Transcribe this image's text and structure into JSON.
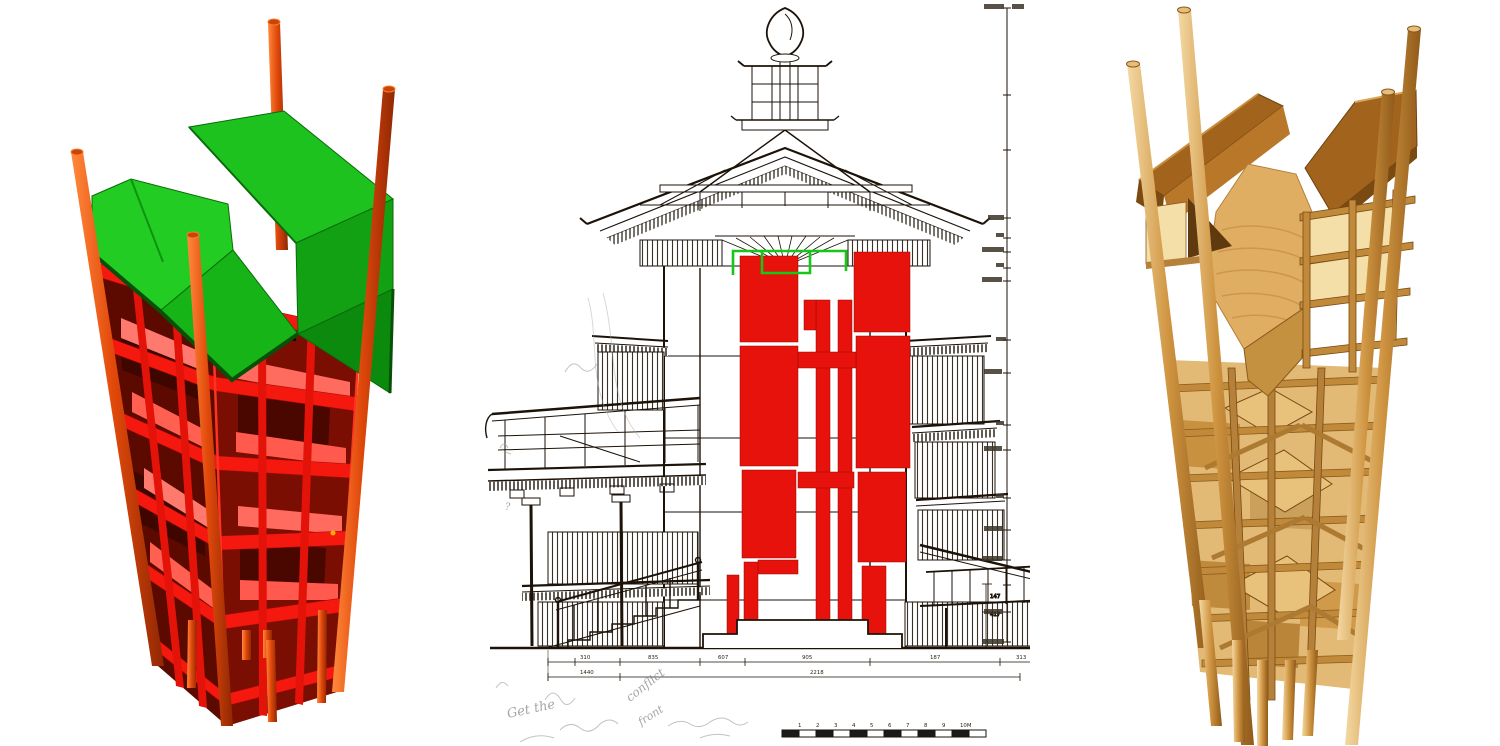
{
  "figure": {
    "panels": [
      {
        "id": "left-model",
        "role": "structural-frame-model-red-green"
      },
      {
        "id": "center-section",
        "role": "pagoda-cross-section-drawing"
      },
      {
        "id": "right-model",
        "role": "timber-frame-wood-model"
      }
    ]
  },
  "colors": {
    "left_model": {
      "post": "#d23c05",
      "frame": "#f5180f",
      "floor_slab": "#ff6b5e",
      "interior": "#5c0900",
      "roof_green": "#1ec21e",
      "roof_green_dark": "#0c8a0e"
    },
    "section": {
      "ink": "#1c1208",
      "core_highlight": "#e8120c",
      "top_highlight_outline": "#17c717",
      "pencil": "#8f8f8f"
    },
    "wood_model": {
      "wood_light": "#f4d9a4",
      "wood_mid": "#cf9440",
      "wood_deep": "#8f5a1a",
      "panel": "#f4dfa8"
    }
  },
  "section": {
    "dimension_row_upper": [
      "310",
      "835",
      "607",
      "905",
      "187",
      "313"
    ],
    "dimension_row_lower": [
      "1440",
      "2218"
    ],
    "side_dimensions": {
      "outer": "417",
      "inner": "147"
    },
    "scalebar": {
      "labels": [
        "1",
        "2",
        "3",
        "4",
        "5",
        "6",
        "7",
        "8",
        "9",
        "10M"
      ]
    },
    "handwriting": {
      "note1": "Get the",
      "note2": "conflict",
      "note3": "front",
      "mark": "?"
    }
  }
}
